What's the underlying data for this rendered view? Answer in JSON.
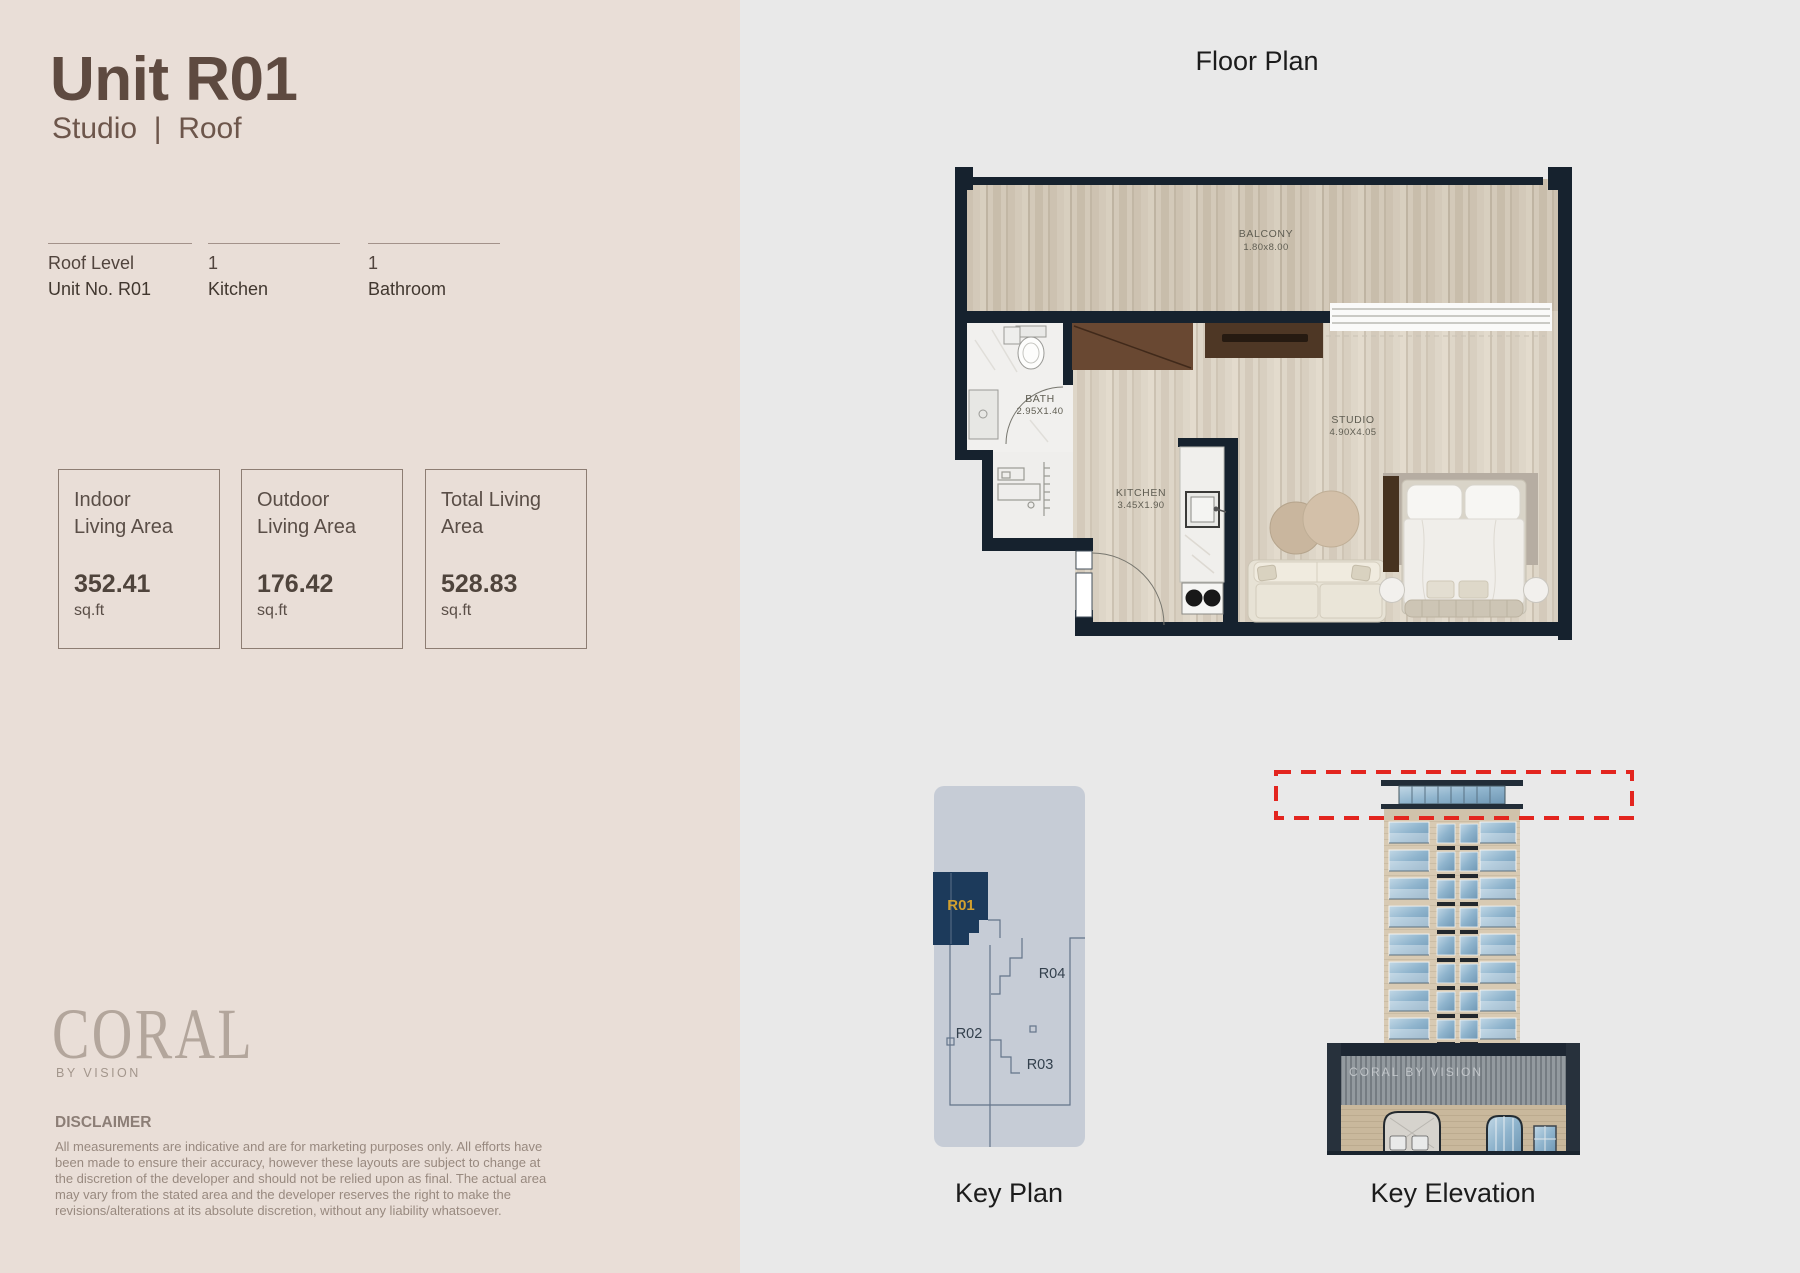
{
  "header": {
    "title": "Unit R01",
    "subtitle": "Studio  |  Roof"
  },
  "specs": [
    {
      "line1": "Roof Level",
      "line2": "Unit No. R01"
    },
    {
      "line1": "1",
      "line2": "Kitchen"
    },
    {
      "line1": "1",
      "line2": "Bathroom"
    }
  ],
  "areas": [
    {
      "label_line1": "Indoor",
      "label_line2": "Living Area",
      "value": "352.41",
      "unit": "sq.ft"
    },
    {
      "label_line1": "Outdoor",
      "label_line2": "Living Area",
      "value": "176.42",
      "unit": "sq.ft"
    },
    {
      "label_line1": "Total Living",
      "label_line2": "Area",
      "value": "528.83",
      "unit": "sq.ft"
    }
  ],
  "brand": {
    "logo": "CORAL",
    "tagline": "BY VISION"
  },
  "disclaimer": {
    "heading": "DISCLAIMER",
    "body": "All measurements are indicative and are for marketing purposes only. All efforts have been made to ensure their accuracy, however these layouts are subject to change at the discretion of the developer and should not be relied upon as final. The actual area may vary from the stated area and the developer reserves the right to make the revisions/alterations at its absolute discretion, without any liability whatsoever."
  },
  "floor_plan": {
    "title": "Floor Plan",
    "rooms": {
      "balcony": {
        "name": "BALCONY",
        "dims": "1.80x8.00"
      },
      "bath": {
        "name": "BATH",
        "dims": "2.95X1.40"
      },
      "kitchen": {
        "name": "KITCHEN",
        "dims": "3.45X1.90"
      },
      "studio": {
        "name": "STUDIO",
        "dims": "4.90X4.05"
      }
    }
  },
  "key_plan": {
    "title": "Key Plan",
    "units": {
      "r01": "R01",
      "r02": "R02",
      "r03": "R03",
      "r04": "R04"
    },
    "highlighted_unit": "R01"
  },
  "key_elevation": {
    "title": "Key Elevation",
    "sign": "CORAL BY VISION"
  },
  "colors": {
    "left_background": "#e9ded7",
    "right_background": "#e9e9e9",
    "title_brown": "#5e4a40",
    "wall_navy": "#16222e",
    "keyplan_fill": "#c6ccd6",
    "highlight_navy": "#1c3a5b",
    "unit_gold": "#d2a02e",
    "elevation_dash_red": "#e3251f"
  }
}
